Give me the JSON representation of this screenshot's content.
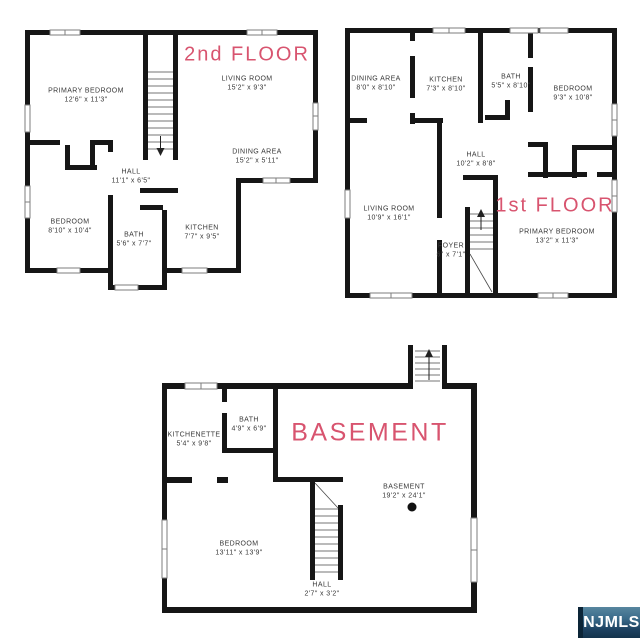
{
  "colors": {
    "wall": "#161616",
    "accent": "#d8546f",
    "text": "#383838",
    "logo-top": "#57869f",
    "logo-bottom": "#14344c",
    "logo-edge": "#0c2537"
  },
  "floors": {
    "second": {
      "title": "2nd FLOOR",
      "rooms": [
        {
          "name": "PRIMARY BEDROOM",
          "dims": "12'6\" x 11'3\""
        },
        {
          "name": "LIVING ROOM",
          "dims": "15'2\" x 9'3\""
        },
        {
          "name": "DINING AREA",
          "dims": "15'2\" x 5'11\""
        },
        {
          "name": "HALL",
          "dims": "11'1\" x 6'5\""
        },
        {
          "name": "BEDROOM",
          "dims": "8'10\" x 10'4\""
        },
        {
          "name": "BATH",
          "dims": "5'6\" x 7'7\""
        },
        {
          "name": "KITCHEN",
          "dims": "7'7\" x 9'5\""
        }
      ]
    },
    "first": {
      "title": "1st FLOOR",
      "rooms": [
        {
          "name": "DINING AREA",
          "dims": "8'0\" x 8'10\""
        },
        {
          "name": "KITCHEN",
          "dims": "7'3\" x 8'10\""
        },
        {
          "name": "BATH",
          "dims": "5'5\" x 8'10\""
        },
        {
          "name": "BEDROOM",
          "dims": "9'3\" x 10'8\""
        },
        {
          "name": "HALL",
          "dims": "10'2\" x 8'8\""
        },
        {
          "name": "LIVING ROOM",
          "dims": "10'9\" x 16'1\""
        },
        {
          "name": "FOYER",
          "dims": "6\" x 7'1\""
        },
        {
          "name": "PRIMARY BEDROOM",
          "dims": "13'2\" x 11'3\""
        }
      ]
    },
    "basement": {
      "title": "BASEMENT",
      "rooms": [
        {
          "name": "KITCHENETTE",
          "dims": "5'4\" x 9'8\""
        },
        {
          "name": "BATH",
          "dims": "4'9\" x 6'9\""
        },
        {
          "name": "BASEMENT",
          "dims": "19'2\" x 24'1\""
        },
        {
          "name": "BEDROOM",
          "dims": "13'11\" x 13'9\""
        },
        {
          "name": "HALL",
          "dims": "2'7\" x 3'2\""
        }
      ]
    }
  },
  "watermark": {
    "label": "NJMLS"
  }
}
